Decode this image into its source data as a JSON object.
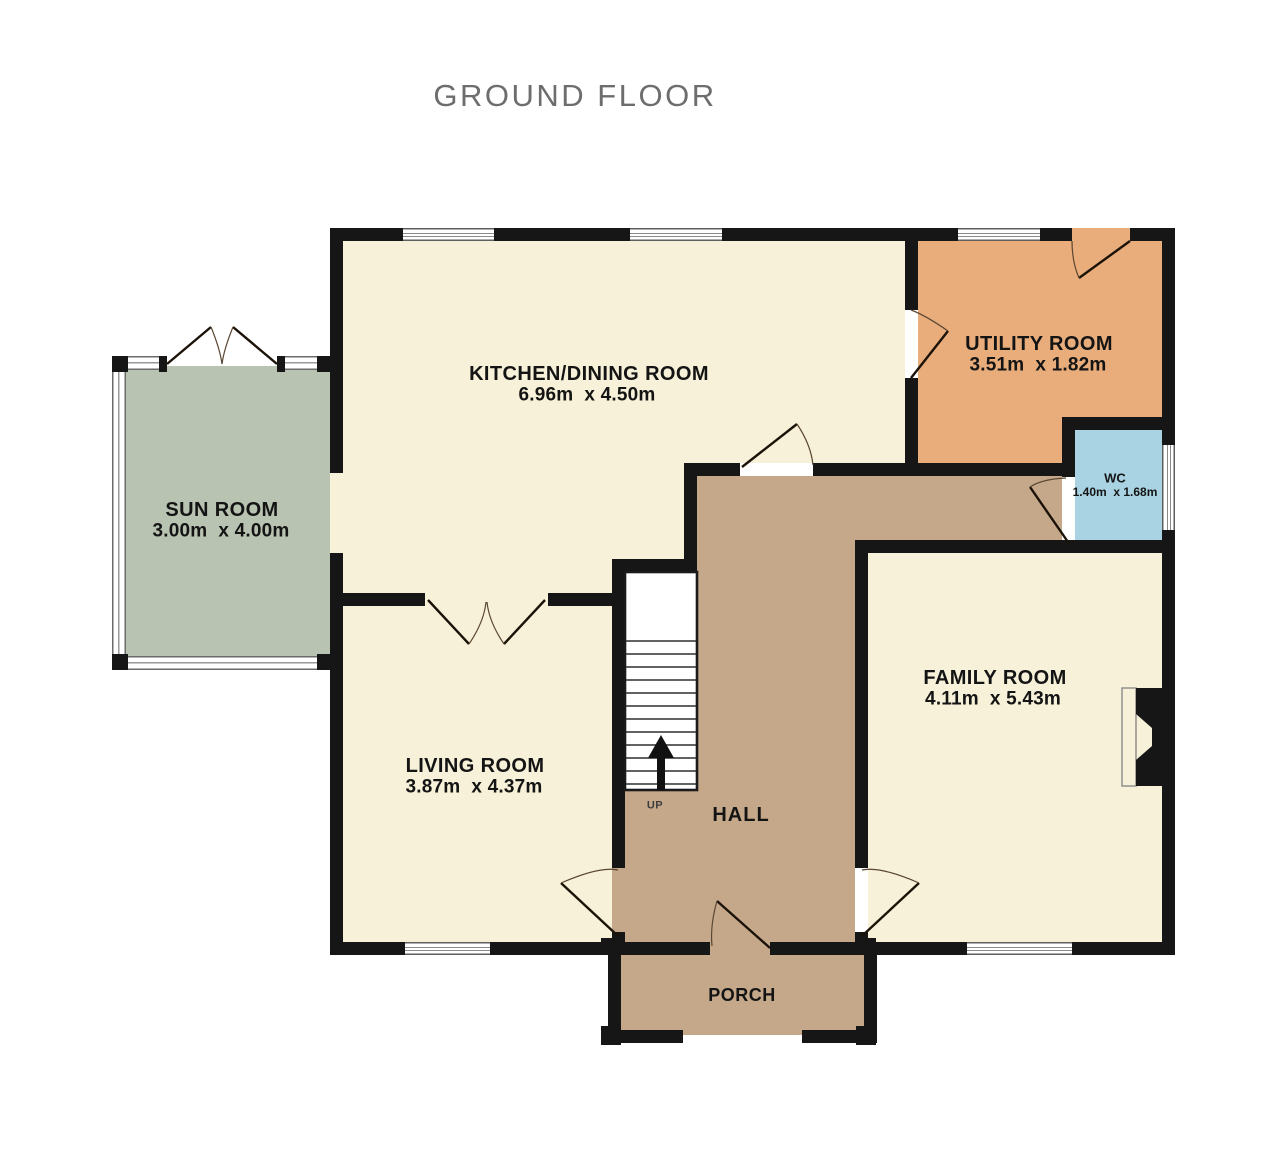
{
  "title": "GROUND FLOOR",
  "rooms": {
    "kitchen": {
      "name": "KITCHEN/DINING ROOM",
      "dims": "6.96m  x 4.50m"
    },
    "utility": {
      "name": "UTILITY ROOM",
      "dims": "3.51m  x 1.82m"
    },
    "wc": {
      "name": "WC",
      "dims": "1.40m  x 1.68m"
    },
    "sunroom": {
      "name": "SUN ROOM",
      "dims": "3.00m  x 4.00m"
    },
    "living": {
      "name": "LIVING ROOM",
      "dims": "3.87m  x 4.37m"
    },
    "family": {
      "name": "FAMILY ROOM",
      "dims": "4.11m  x 5.43m"
    },
    "hall": {
      "name": "HALL"
    },
    "porch": {
      "name": "PORCH"
    }
  },
  "stairs": {
    "label": "UP"
  },
  "colors": {
    "floor_cream": "#f6f1d8",
    "floor_tan": "#c5a88a",
    "floor_orange": "#e9ad7c",
    "floor_blue": "#a9d3e2",
    "floor_sage": "#b9c3b1",
    "wall_black": "#161616",
    "title_gray": "#6d6d6d"
  }
}
